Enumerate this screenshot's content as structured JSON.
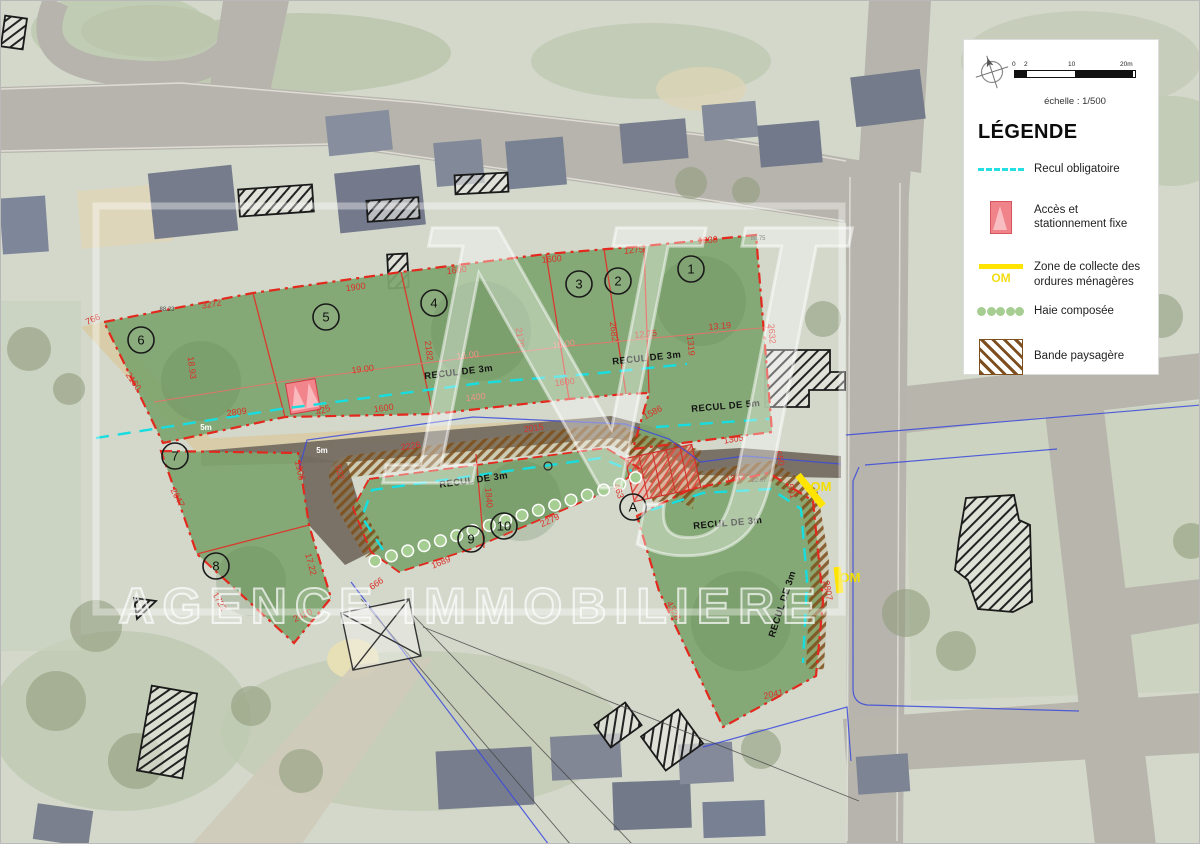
{
  "legend": {
    "title": "LÉGENDE",
    "scale_caption": "échelle : 1/500",
    "scale_ticks": [
      "0",
      "2",
      "10",
      "20m"
    ],
    "items": [
      {
        "symbol": "cyan-dashed-line",
        "label": "Recul obligatoire"
      },
      {
        "symbol": "pink-access-marker",
        "label": "Accès et stationnement fixe"
      },
      {
        "symbol": "yellow-om-line",
        "symbol_text": "OM",
        "label": "Zone de collecte des ordures ménagères"
      },
      {
        "symbol": "green-dots",
        "label": "Haie composée"
      },
      {
        "symbol": "brown-hatch",
        "label": "Bande paysagère"
      }
    ]
  },
  "watermark": {
    "initials": "NJ",
    "agency": "AGENCE IMMOBILIERE"
  },
  "map": {
    "plots": [
      {
        "id": "1",
        "x": 690,
        "y": 268
      },
      {
        "id": "2",
        "x": 617,
        "y": 280
      },
      {
        "id": "3",
        "x": 578,
        "y": 283
      },
      {
        "id": "4",
        "x": 433,
        "y": 302
      },
      {
        "id": "5",
        "x": 325,
        "y": 316
      },
      {
        "id": "6",
        "x": 140,
        "y": 339
      },
      {
        "id": "7",
        "x": 174,
        "y": 455
      },
      {
        "id": "8",
        "x": 215,
        "y": 565
      },
      {
        "id": "9",
        "x": 470,
        "y": 538
      },
      {
        "id": "10",
        "x": 503,
        "y": 525
      },
      {
        "id": "A",
        "x": 632,
        "y": 506
      }
    ],
    "measurements": [
      {
        "t": "3272",
        "x": 211,
        "y": 306,
        "r": -10
      },
      {
        "t": "1900",
        "x": 355,
        "y": 289,
        "r": -8
      },
      {
        "t": "1600",
        "x": 456,
        "y": 272,
        "r": -7
      },
      {
        "t": "1600",
        "x": 551,
        "y": 261,
        "r": -6
      },
      {
        "t": "1275",
        "x": 633,
        "y": 252,
        "r": -5
      },
      {
        "t": "1330",
        "x": 707,
        "y": 242,
        "r": -4
      },
      {
        "t": "88.75",
        "x": 757,
        "y": 239,
        "r": 0,
        "k": "tiny"
      },
      {
        "t": "88.23",
        "x": 166,
        "y": 310,
        "r": 0,
        "k": "tiny"
      },
      {
        "t": "766",
        "x": 93,
        "y": 321,
        "r": -25
      },
      {
        "t": "2160",
        "x": 130,
        "y": 382,
        "r": 55
      },
      {
        "t": "18.93",
        "x": 188,
        "y": 367,
        "r": 83
      },
      {
        "t": "2809",
        "x": 236,
        "y": 414,
        "r": -8
      },
      {
        "t": "19.00",
        "x": 362,
        "y": 371,
        "r": -7
      },
      {
        "t": "2182",
        "x": 425,
        "y": 350,
        "r": 83
      },
      {
        "t": "16.00",
        "x": 467,
        "y": 357,
        "r": -7,
        "k": "pale"
      },
      {
        "t": "2179",
        "x": 516,
        "y": 337,
        "r": 83
      },
      {
        "t": "16.00",
        "x": 563,
        "y": 346,
        "r": -7,
        "k": "pale"
      },
      {
        "t": "2682",
        "x": 610,
        "y": 331,
        "r": 83
      },
      {
        "t": "12.75",
        "x": 645,
        "y": 336,
        "r": -6
      },
      {
        "t": "13.19",
        "x": 719,
        "y": 328,
        "r": -5
      },
      {
        "t": "1319",
        "x": 687,
        "y": 345,
        "r": 85
      },
      {
        "t": "2632",
        "x": 768,
        "y": 333,
        "r": 85
      },
      {
        "t": "1600",
        "x": 383,
        "y": 410,
        "r": -8
      },
      {
        "t": "1600",
        "x": 564,
        "y": 384,
        "r": -7
      },
      {
        "t": "1400",
        "x": 475,
        "y": 399,
        "r": -7,
        "k": "pale"
      },
      {
        "t": "425",
        "x": 323,
        "y": 412,
        "r": -20
      },
      {
        "t": "2226",
        "x": 410,
        "y": 448,
        "r": -8
      },
      {
        "t": "2015",
        "x": 533,
        "y": 430,
        "r": -8
      },
      {
        "t": "1586",
        "x": 653,
        "y": 414,
        "r": -28
      },
      {
        "t": "1305",
        "x": 733,
        "y": 441,
        "r": -10
      },
      {
        "t": "650",
        "x": 776,
        "y": 458,
        "r": 75
      },
      {
        "t": "1347",
        "x": 735,
        "y": 480,
        "r": -8
      },
      {
        "t": "22.67",
        "x": 758,
        "y": 481,
        "r": 0,
        "k": "tiny"
      },
      {
        "t": "501",
        "x": 788,
        "y": 491,
        "r": 75
      },
      {
        "t": "1906",
        "x": 296,
        "y": 470,
        "r": 78
      },
      {
        "t": "522",
        "x": 336,
        "y": 472,
        "r": 75
      },
      {
        "t": "2047",
        "x": 174,
        "y": 498,
        "r": 62
      },
      {
        "t": "17.22",
        "x": 307,
        "y": 564,
        "r": 75
      },
      {
        "t": "1722",
        "x": 216,
        "y": 602,
        "r": 60
      },
      {
        "t": "2420",
        "x": 303,
        "y": 617,
        "r": -25
      },
      {
        "t": "666",
        "x": 377,
        "y": 585,
        "r": -35
      },
      {
        "t": "1840",
        "x": 485,
        "y": 497,
        "r": 85
      },
      {
        "t": "2279",
        "x": 550,
        "y": 522,
        "r": -25
      },
      {
        "t": "1689",
        "x": 441,
        "y": 564,
        "r": -22
      },
      {
        "t": "463",
        "x": 615,
        "y": 491,
        "r": 72
      },
      {
        "t": "4328",
        "x": 670,
        "y": 611,
        "r": 62
      },
      {
        "t": "2041",
        "x": 773,
        "y": 696,
        "r": -12
      },
      {
        "t": "2807",
        "x": 824,
        "y": 590,
        "r": 80
      }
    ],
    "recul_labels": [
      {
        "t": "RECUL DE 3m",
        "x": 458,
        "y": 374,
        "r": -7
      },
      {
        "t": "RECUL DE 3m",
        "x": 646,
        "y": 360,
        "r": -6
      },
      {
        "t": "RECUL DE 5m",
        "x": 725,
        "y": 408,
        "r": -5
      },
      {
        "t": "RECUL DE 3m",
        "x": 473,
        "y": 482,
        "r": -8
      },
      {
        "t": "RECUL DE 3m",
        "x": 727,
        "y": 525,
        "r": -5
      },
      {
        "t": "RECUL DE 3m",
        "x": 784,
        "y": 604,
        "r": -72
      }
    ],
    "om_marks": [
      {
        "label": "OM",
        "x": 820,
        "y": 490
      },
      {
        "label": "OM",
        "x": 849,
        "y": 581
      }
    ],
    "road_width_markers": [
      {
        "label": "5m",
        "x": 205,
        "y": 429
      },
      {
        "label": "5m",
        "x": 321,
        "y": 452
      }
    ]
  },
  "colors": {
    "plot_green": "#7ea56f",
    "boundary_red": "#e3281d",
    "recul_cyan": "#1adde0",
    "om_yellow": "#ffe400",
    "haie_green": "#a6cd92",
    "bande_brown": "#7d4e1e",
    "access_pink": "#f0828a",
    "road_brown": "#756d61",
    "path_sand": "#d9cda9",
    "utility_blue": "#3b49dd"
  }
}
